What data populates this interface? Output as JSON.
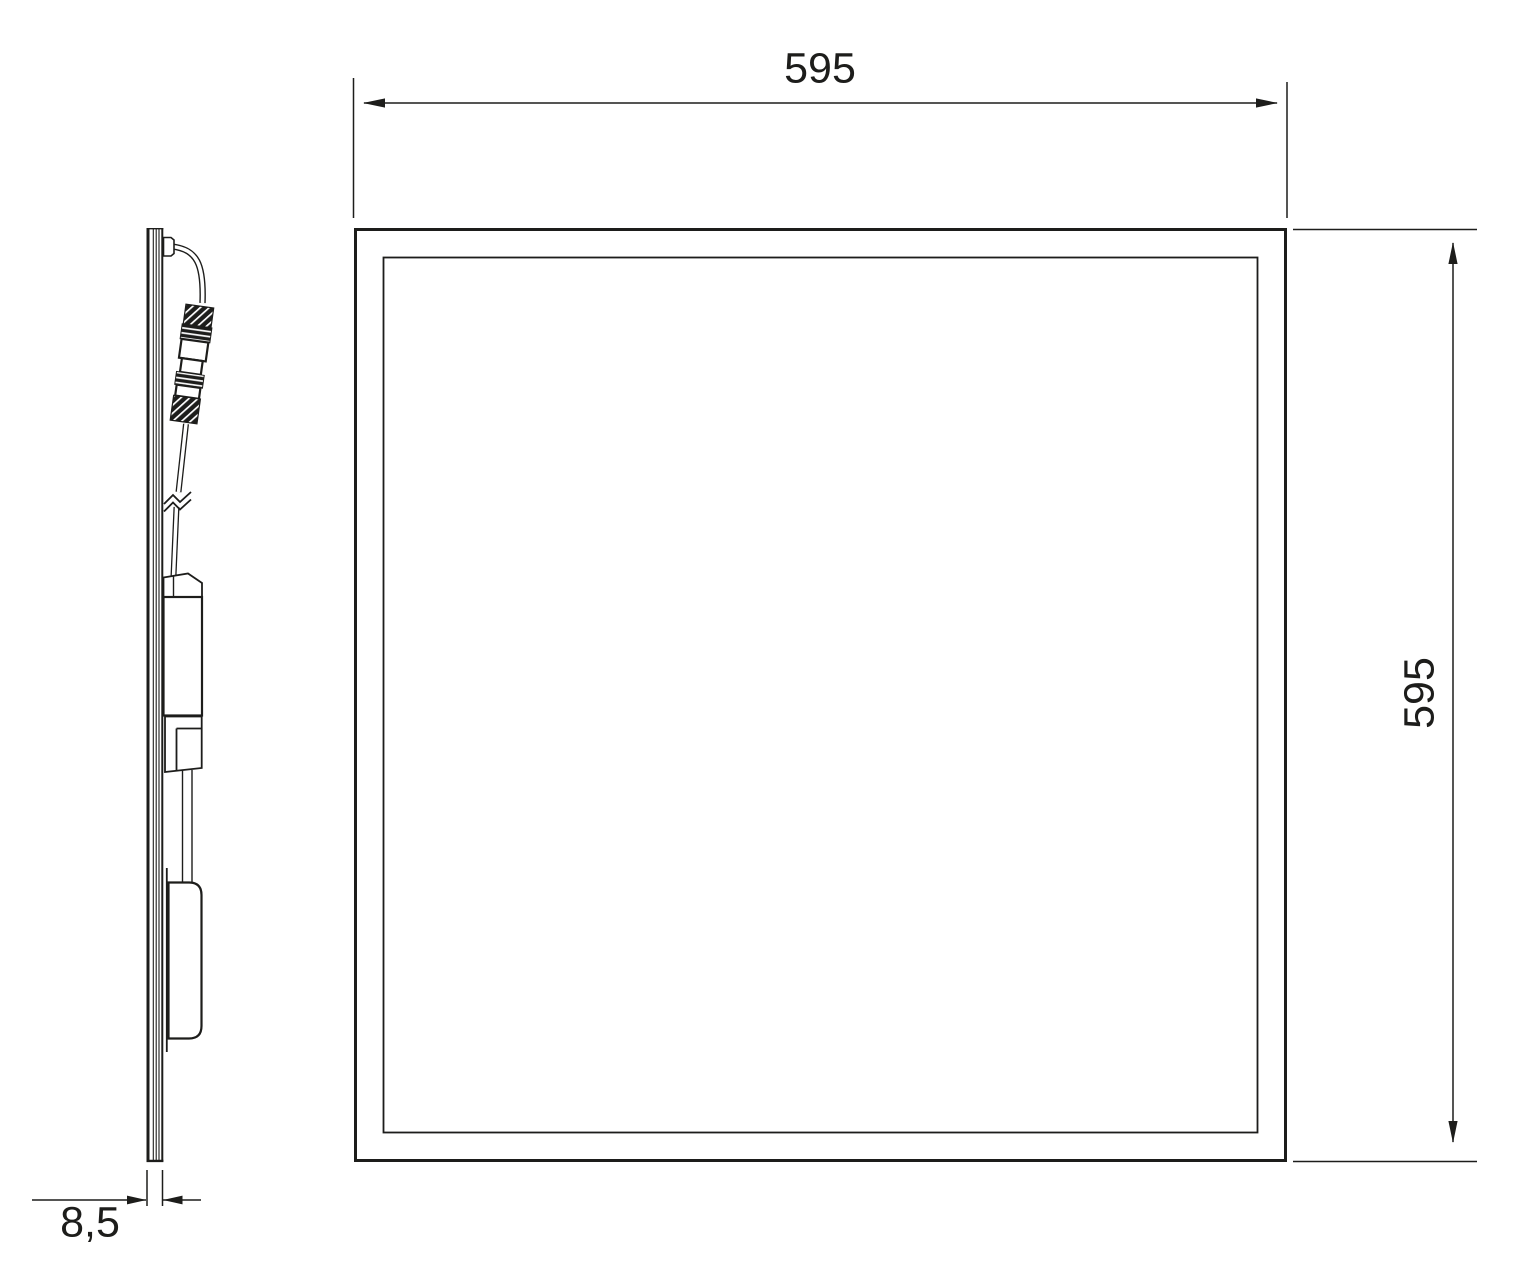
{
  "dimensions": {
    "top_width": "595",
    "right_height": "595",
    "side_thickness": "8,5"
  },
  "colors": {
    "line": "#1d1d1b",
    "background": "#ffffff"
  }
}
